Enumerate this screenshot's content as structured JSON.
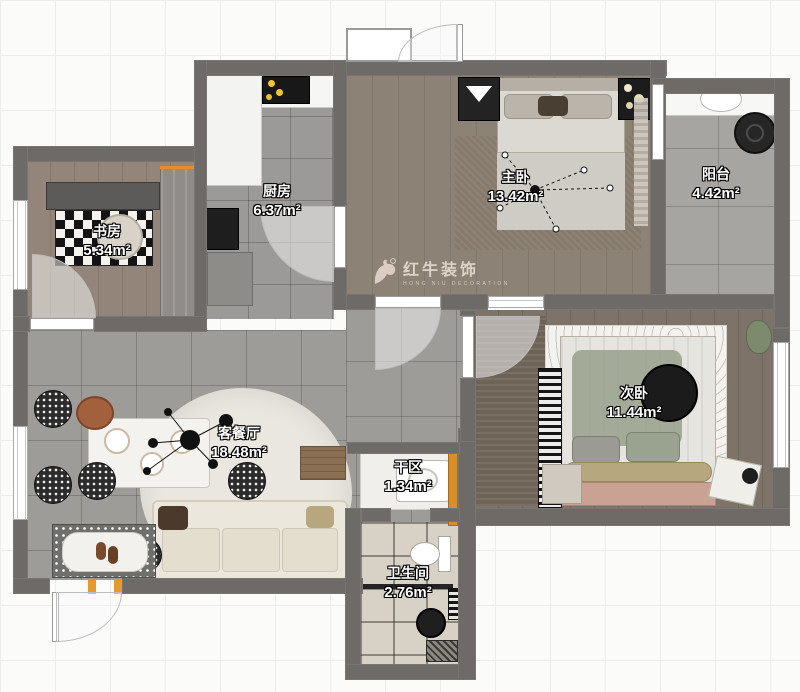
{
  "watermark": {
    "brand": "红牛装饰",
    "subtitle": "HONG NIU DECORATION"
  },
  "rooms": {
    "study": {
      "name": "书房",
      "area": "5.34m²"
    },
    "kitchen": {
      "name": "厨房",
      "area": "6.37m²"
    },
    "master": {
      "name": "主卧",
      "area": "13.42m²"
    },
    "balcony": {
      "name": "阳台",
      "area": "4.42m²"
    },
    "second": {
      "name": "次卧",
      "area": "11.44m²"
    },
    "living": {
      "name": "客餐厅",
      "area": "18.48m²"
    },
    "dry": {
      "name": "干区",
      "area": "1.34m²"
    },
    "bath": {
      "name": "卫生间",
      "area": "2.76m²"
    }
  },
  "colors": {
    "wall": "#6d6a67",
    "accent_orange": "#dd9130",
    "label_text": "#ffffff",
    "label_outline": "#000000",
    "watermark": "#e6dad1"
  }
}
